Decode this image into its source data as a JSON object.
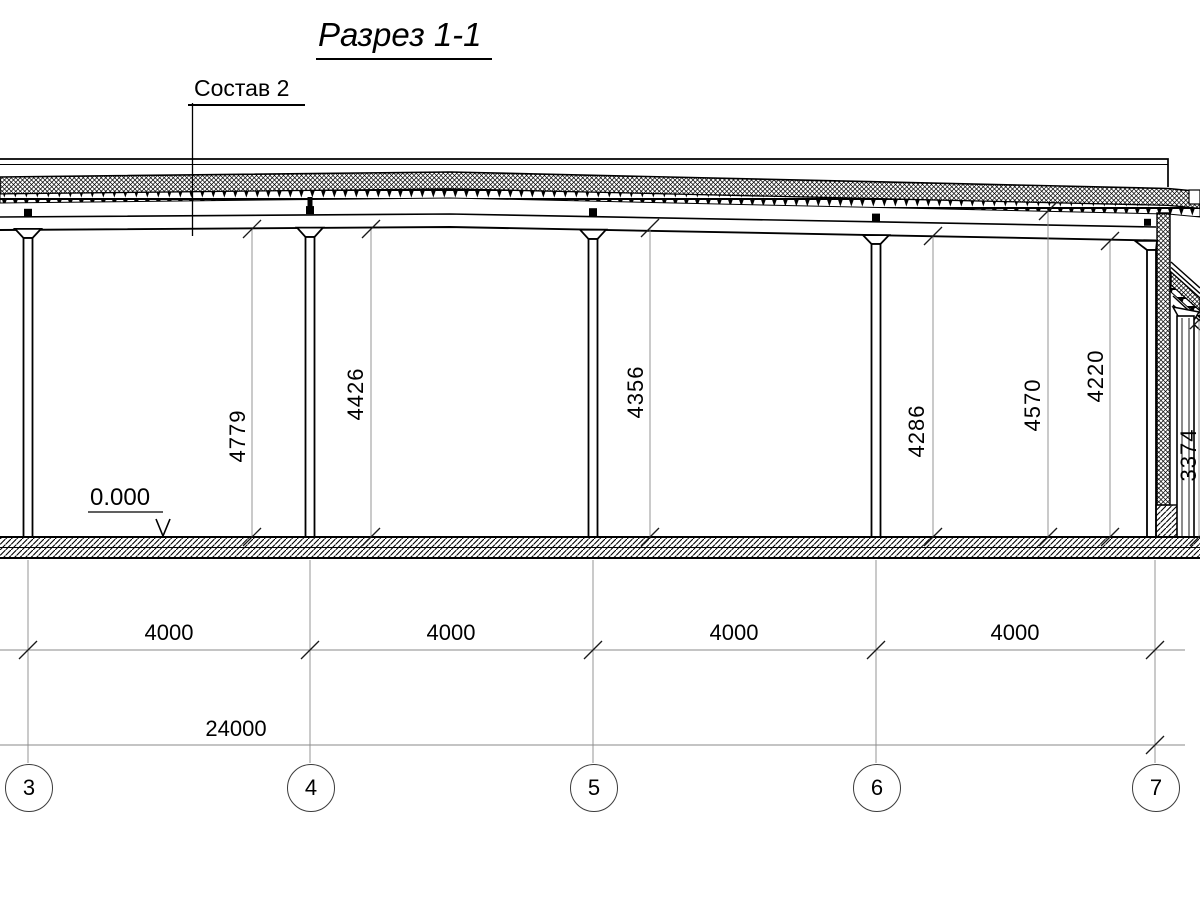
{
  "title": "Разрез 1-1",
  "composition_label": "Состав 2",
  "level_mark": "0.000",
  "vertical_dims": [
    "4779",
    "4426",
    "4356",
    "4286",
    "4570",
    "4220",
    "3374"
  ],
  "bay_dims": [
    "4000",
    "4000",
    "4000",
    "4000"
  ],
  "total_dim": "24000",
  "grid_axes": [
    "3",
    "4",
    "5",
    "6",
    "7"
  ],
  "colors": {
    "line": "#000000",
    "dim_line": "#8a8a8a",
    "background": "#ffffff"
  }
}
